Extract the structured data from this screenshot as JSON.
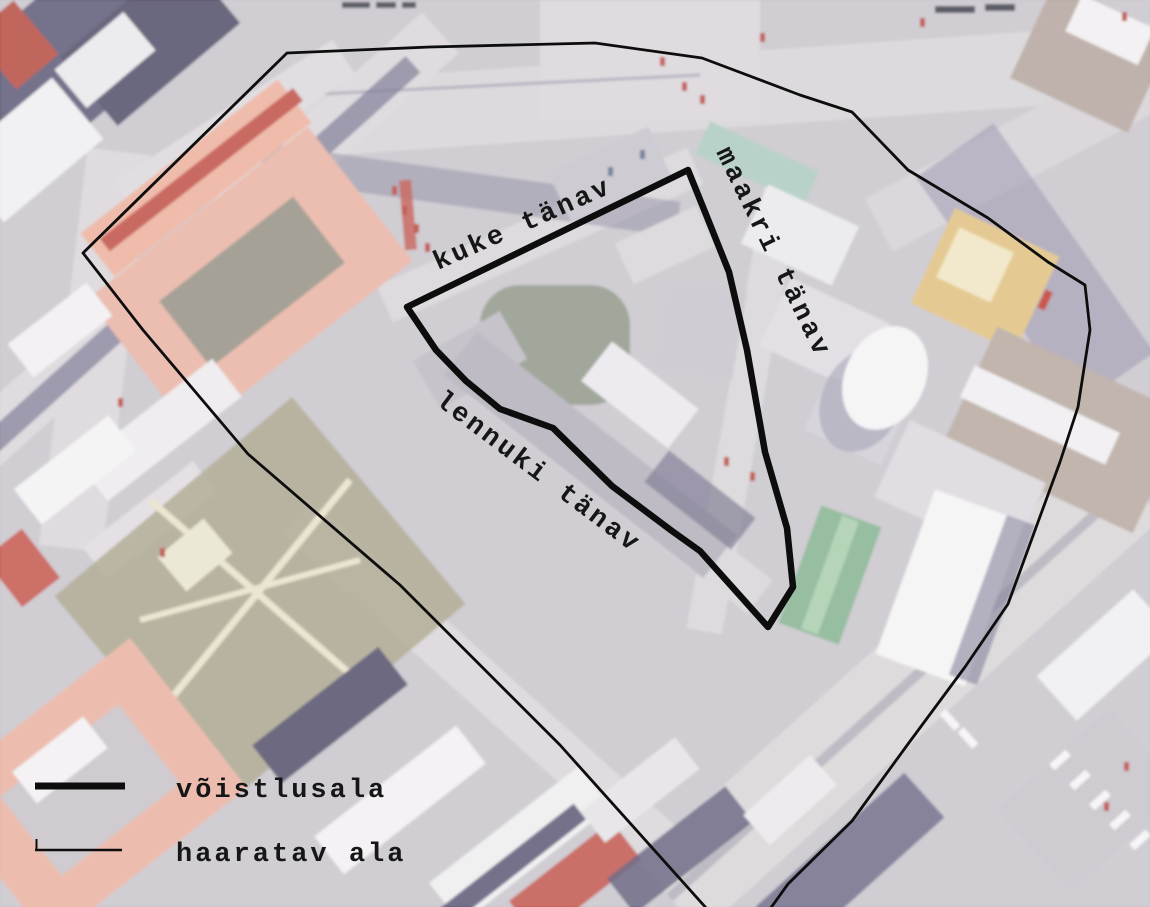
{
  "map": {
    "kind": "aerial-photo-planning-map",
    "streets": {
      "kuke": "kuke tänav",
      "maakri": "maakri tänav",
      "lennuki": "lennuki tänav"
    },
    "legend": {
      "items": [
        {
          "label": "võistlusala",
          "line_style": "thick"
        },
        {
          "label": "haaratav ala",
          "line_style": "thin"
        }
      ]
    },
    "boundaries": {
      "line_color": "#0d0d0d",
      "competition_area": {
        "stroke_width": "6.5",
        "points": "688,170 705,212 729,272 747,350 765,452 787,528 793,587 768,627 700,551 672,531 612,486 553,428 500,409 466,381 436,350 407,307"
      },
      "covered_area": {
        "stroke_width": "2.8",
        "points": "83,253 287,53 430,47 595,43 702,58 800,95 852,112 908,170 988,218 1048,262 1085,285 1090,330 1078,407 1060,462 1008,604 965,667 908,744 852,821 788,884 742,948 560,745 400,585 248,454 143,330"
      }
    }
  }
}
